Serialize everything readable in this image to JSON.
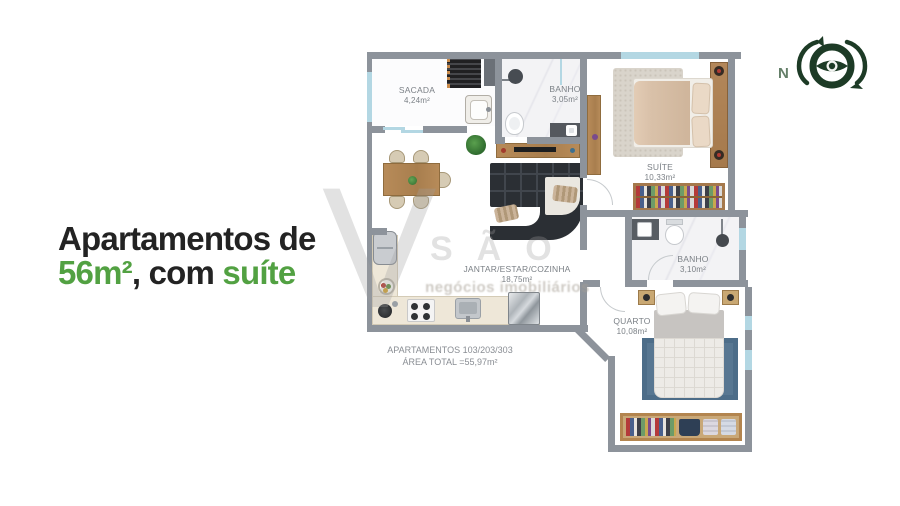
{
  "headline": {
    "line1": "Apartamentos de",
    "green1": "56m²",
    "mid": ", com ",
    "green2": "suíte",
    "dark_color": "#232323",
    "green_color": "#52a142"
  },
  "compass": {
    "north_label": "N",
    "color": "#1d3b26"
  },
  "watermark": {
    "letter": "V",
    "word": "SÃO",
    "tagline": "negócios imobiliários"
  },
  "plan": {
    "colors": {
      "wall": "#8d939b",
      "window_glass": "#b3d7e3",
      "wood": "#b3854f",
      "marble": "#f3f3f5",
      "kitchen_counter": "#eee7d8",
      "sofa": "#2b2f34",
      "suite_rug": "#d9d4cb",
      "quarto_rug": "#587792",
      "bed_duvet": "#d9c1a9"
    },
    "rooms": {
      "sacada": {
        "name": "SACADA",
        "area": "4,24m²"
      },
      "banho1": {
        "name": "BANHO",
        "area": "3,05m²"
      },
      "suite": {
        "name": "SUÍTE",
        "area": "10,33m²"
      },
      "jantar": {
        "name": "JANTAR/ESTAR/COZINHA",
        "area": "18,75m²"
      },
      "banho2": {
        "name": "BANHO",
        "area": "3,10m²"
      },
      "quarto": {
        "name": "QUARTO",
        "area": "10,08m²"
      }
    },
    "footer": {
      "line1": "APARTAMENTOS 103/203/303",
      "line2": "ÁREA TOTAL =55,97m²"
    },
    "furniture": [
      "ac-condenser",
      "laundry-tub",
      "shower-head",
      "toilet",
      "vanity-sink",
      "mirror",
      "double-bed",
      "pillows",
      "nightstand-lamp",
      "wardrobe-clothes",
      "dining-table",
      "dining-chair",
      "plant",
      "tv-sideboard",
      "corner-sofa",
      "fridge",
      "cooktop",
      "kitchen-sink",
      "stainless-appliance",
      "fruit-bowl",
      "kettle",
      "rug"
    ]
  }
}
